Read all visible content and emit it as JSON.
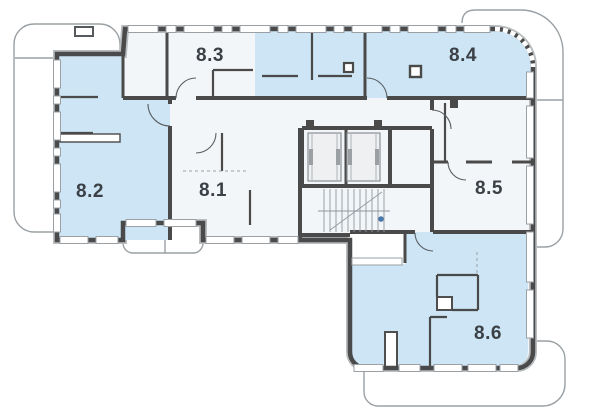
{
  "plan": {
    "type": "apartment-floor-plan",
    "floor_units": [
      "8.1",
      "8.2",
      "8.3",
      "8.4",
      "8.5",
      "8.6"
    ],
    "apartments": [
      {
        "label": "8.1",
        "highlighted": false
      },
      {
        "label": "8.2",
        "highlighted": true
      },
      {
        "label": "8.3",
        "highlighted": false
      },
      {
        "label": "8.4",
        "highlighted": true
      },
      {
        "label": "8.5",
        "highlighted": false
      },
      {
        "label": "8.6",
        "highlighted": true
      }
    ],
    "colors": {
      "highlight_fill": "#cde5f4",
      "base_fill": "#f3f6f8",
      "wall": "#4a4a4a",
      "wall_edge": "#b9bdbf",
      "balcony_outline": "#9aa0a4",
      "label_text": "#3b4046",
      "stair_marker": "#4a77ab"
    },
    "core": {
      "elevator_count": 2,
      "has_staircase": true
    }
  }
}
